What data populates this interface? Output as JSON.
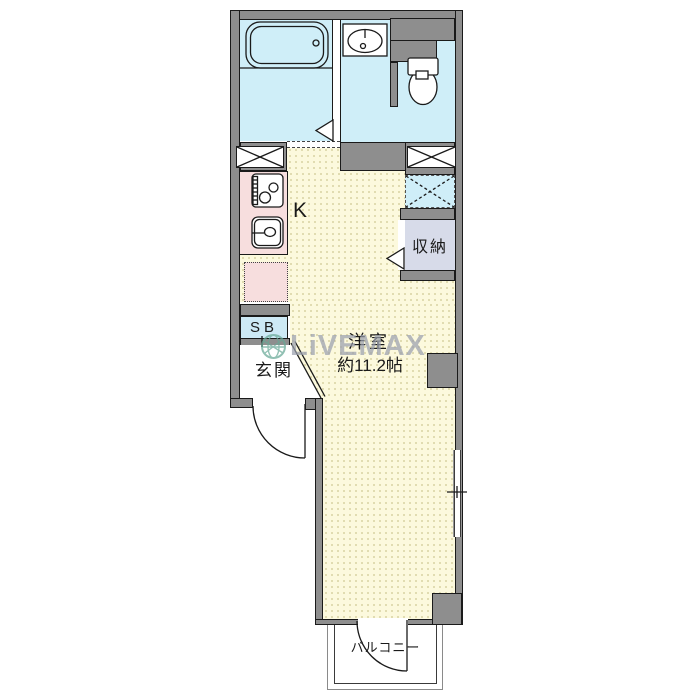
{
  "floorplan": {
    "labels": {
      "kitchen": "K",
      "closet": "収納",
      "shoe_box": "SB",
      "entrance": "玄関",
      "main_room": "洋室",
      "main_room_size": "約11.2帖",
      "balcony": "バルコニー"
    },
    "watermark": {
      "brand": "LiVEMAX"
    },
    "colors": {
      "wall": "#8e8e8e",
      "room_yellow": "#fcf9dd",
      "wet_area_cyan": "#cfeef8",
      "kitchen_pink": "#f7dede",
      "closet_lavender": "#d7dbe9",
      "shoebox_blue": "#cde9f5",
      "line": "#1a1a1a",
      "watermark_gray": "#9aa0ae",
      "watermark_globe": "#68a896"
    },
    "icons": [
      "bathtub-icon",
      "washbasin-icon",
      "toilet-icon",
      "stove-icon",
      "kitchen-sink-icon",
      "pipe-space-x-icon",
      "washer-space-x-icon",
      "door-swing-arc-icon",
      "door-triangle-icon",
      "window-icon",
      "globe-icon"
    ]
  }
}
